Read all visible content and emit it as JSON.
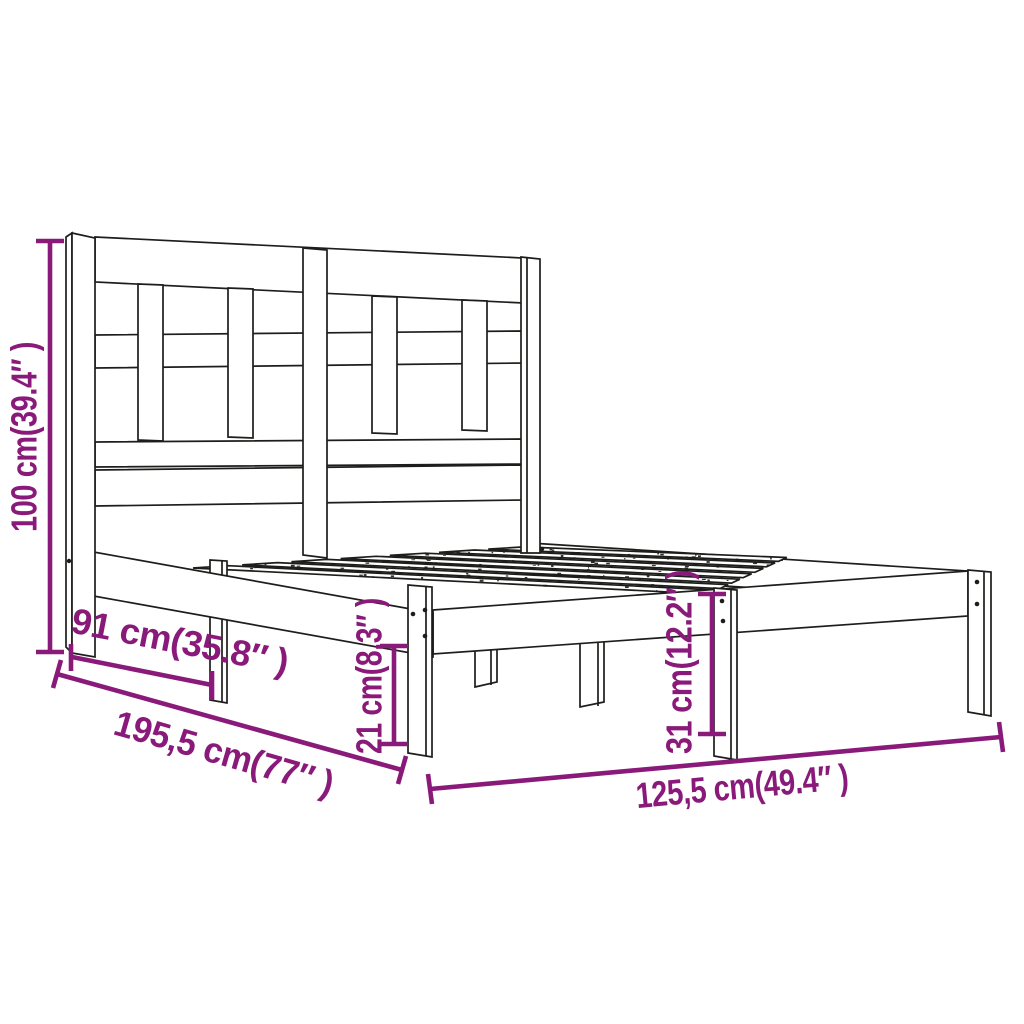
{
  "figure": {
    "type": "product-dimension-diagram",
    "subject": "wooden bed frame with lattice headboard and slatted base",
    "background_color": "#ffffff",
    "line_art_color": "#1d1d1b",
    "dimension_color": "#8a1a7a"
  },
  "dimensions": {
    "headboard_height": {
      "label": "100 cm(39.4″ )",
      "cm": "100",
      "inch": "39.4″",
      "orientation": "vertical-left"
    },
    "upper_length": {
      "label": "91 cm(35.8″ )",
      "cm": "91",
      "inch": "35.8″",
      "orientation": "diagonal-along-length"
    },
    "total_length": {
      "label": "195,5 cm(77″ )",
      "cm": "195,5",
      "inch": "77″",
      "orientation": "diagonal-along-length-floor"
    },
    "clearance_height": {
      "label": "21 cm(8.3″ )",
      "cm": "21",
      "inch": "8.3″",
      "orientation": "vertical-under-rail"
    },
    "rail_height": {
      "label": "31 cm(12.2″ )",
      "cm": "31",
      "inch": "12.2″",
      "orientation": "vertical-at-foot"
    },
    "total_width": {
      "label": "125,5 cm(49.4″ )",
      "cm": "125,5",
      "inch": "49.4″",
      "orientation": "diagonal-along-width-floor"
    }
  }
}
